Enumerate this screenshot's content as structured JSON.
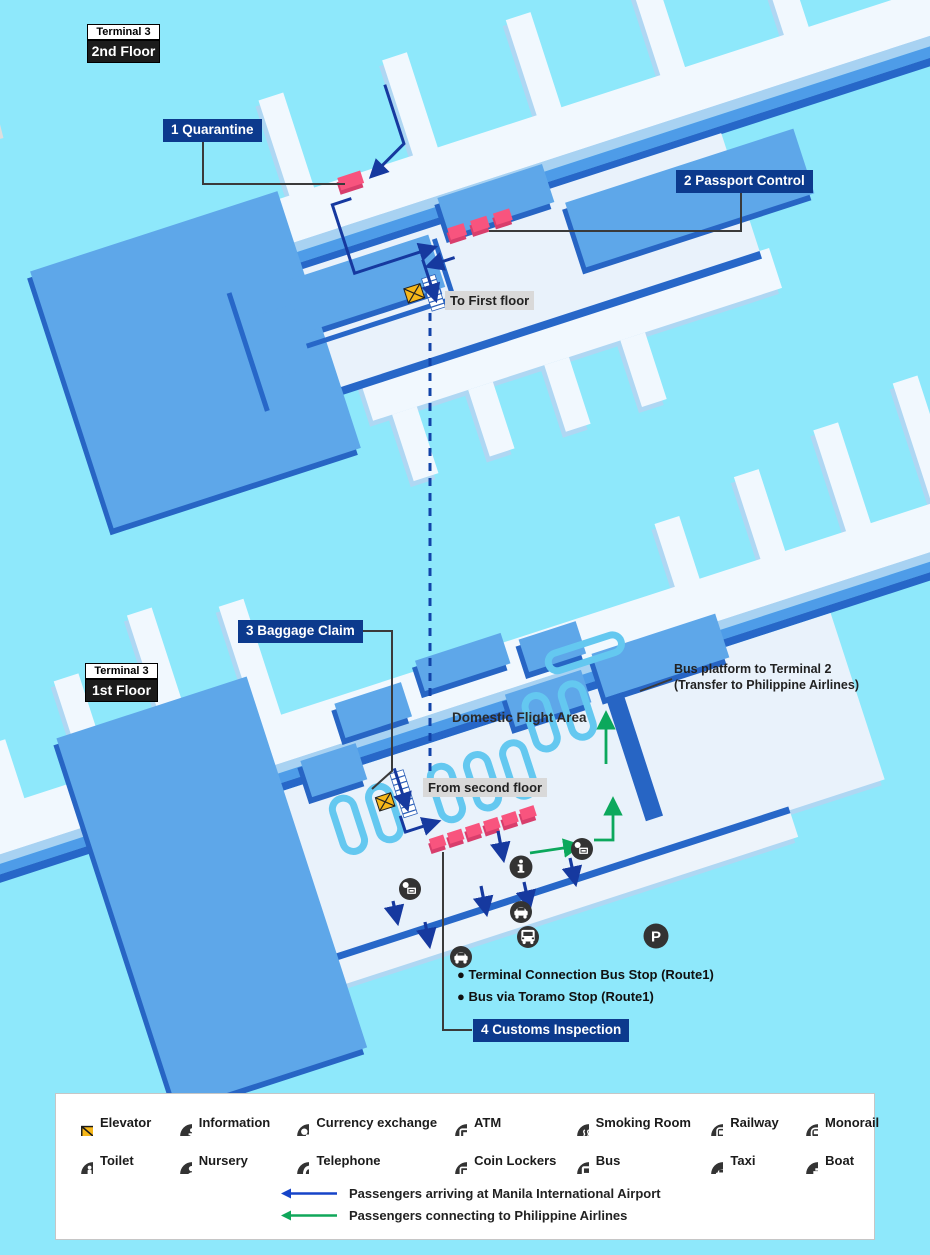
{
  "floor2": {
    "terminal": "Terminal 3",
    "floor": "2nd Floor",
    "labels": {
      "quarantine": "1 Quarantine",
      "passport": "2 Passport Control",
      "to_first": "To First floor"
    }
  },
  "floor1": {
    "terminal": "Terminal 3",
    "floor": "1st Floor",
    "labels": {
      "baggage": "3 Baggage Claim",
      "customs": "4 Customs Inspection",
      "from_second": "From second floor",
      "domestic": "Domestic Flight Area",
      "bus_platform_line1": "Bus platform to Terminal 2",
      "bus_platform_line2": "(Transfer to Philippine Airlines)",
      "bus_stop_1": "● Terminal Connection Bus Stop (Route1)",
      "bus_stop_2": "● Bus via Toramo Stop (Route1)",
      "parking": "P"
    }
  },
  "legend": {
    "items": [
      {
        "icon": "elevator-icon",
        "label": "Elevator"
      },
      {
        "icon": "information-icon",
        "label": "Information"
      },
      {
        "icon": "currency-exchange-icon",
        "label": "Currency exchange"
      },
      {
        "icon": "atm-icon",
        "label": "ATM"
      },
      {
        "icon": "smoking-room-icon",
        "label": "Smoking Room"
      },
      {
        "icon": "railway-icon",
        "label": "Railway"
      },
      {
        "icon": "monorail-icon",
        "label": "Monorail"
      },
      {
        "icon": "toilet-icon",
        "label": "Toilet"
      },
      {
        "icon": "nursery-icon",
        "label": "Nursery"
      },
      {
        "icon": "telephone-icon",
        "label": "Telephone"
      },
      {
        "icon": "coin-lockers-icon",
        "label": "Coin Lockers"
      },
      {
        "icon": "bus-icon",
        "label": "Bus"
      },
      {
        "icon": "taxi-icon",
        "label": "Taxi"
      },
      {
        "icon": "boat-icon",
        "label": "Boat"
      }
    ],
    "arrows": [
      {
        "color": "#1644C8",
        "label": "Passengers arriving at Manila International Airport"
      },
      {
        "color": "#10A75A",
        "label": "Passengers connecting to Philippine Airlines"
      }
    ]
  },
  "colors": {
    "background": "#8EE8FB",
    "building_blue": "#5EA7E9",
    "building_dark_edge": "#2765C4",
    "floor_white": "#F1F8FE",
    "counter_pink": "#F8547E",
    "label_navy_bg": "#0C3A8D",
    "label_gray_bg": "#D9D9D9",
    "route_arrow_blue": "#16399F",
    "route_arrow_green": "#0CA85C",
    "legend_icon_dark": "#333333",
    "elevator_yellow": "#F6B719",
    "road_gray": "#DEDEDE"
  }
}
